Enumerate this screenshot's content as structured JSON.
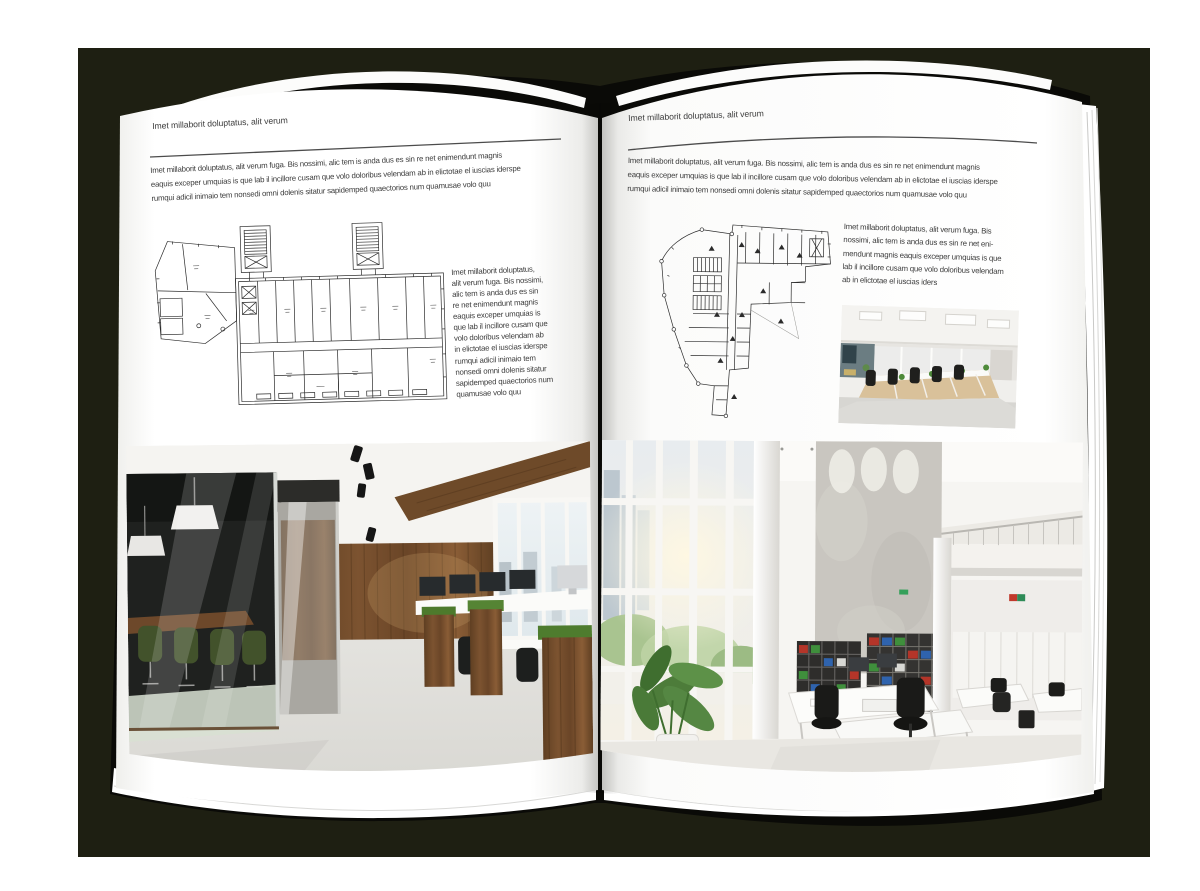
{
  "book": {
    "backdrop_color": "#1e1f12",
    "cover_color": "#0a0a07",
    "page_color": "#ffffff",
    "accent_green": "#44582b",
    "accent_wood": "#6e4a29"
  },
  "left_page": {
    "header": "Imet millaborit doluptatus, alit verum",
    "intro": "Imet millaborit doluptatus, alit verum fuga. Bis nossimi, alic tem is anda dus es sin re net enimendunt magnis\neaquis exceper umquias is que lab il incillore cusam que volo doloribus velendam ab in elictotae el iuscias iderspe\nrumqui adicil inimaio tem nonsedi omni dolenis sitatur sapidemped quaectorios num quamusae volo quu",
    "side_text": "Imet millaborit doluptatus,\nalit verum fuga. Bis nossimi,\nalic tem is anda dus es sin\nre net enimendunt magnis\neaquis exceper umquias is\nque lab il incillore cusam que\nvolo doloribus velendam ab\nin elictotae el iuscias iderspe\nrumqui adicil inimaio tem\nnonsedi omni dolenis sitatur\nsapidemped quaectorios num\nquamusae volo quu",
    "floor_plan": "architectural-floor-plan-wide-building",
    "photo": "office-interior-glass-meeting-room-wood-wall"
  },
  "right_page": {
    "header": "Imet millaborit doluptatus, alit verum",
    "intro": "Imet millaborit doluptatus, alit verum fuga. Bis nossimi, alic tem is anda dus es sin re net enimendunt magnis\neaquis exceper umquias is que lab il incillore cusam que volo doloribus velendam ab in elictotae el iuscias iderspe\nrumqui adicil inimaio tem nonsedi omni dolenis sitatur sapidemped quaectorios num quamusae volo quu",
    "side_text": "Imet millaborit doluptatus, alit verum fuga. Bis\nnossimi, alic tem is anda dus es sin re net eni-\nmendunt magnis eaquis exceper umquias is que\nlab il incillore cusam que volo doloribus velendam\nab in elictotae el iuscias iders",
    "floor_plan": "architectural-floor-plan-irregular-building",
    "photo_small": "open-plan-office-desk-rows",
    "photo_large": "bright-double-height-office-bookshelves"
  }
}
